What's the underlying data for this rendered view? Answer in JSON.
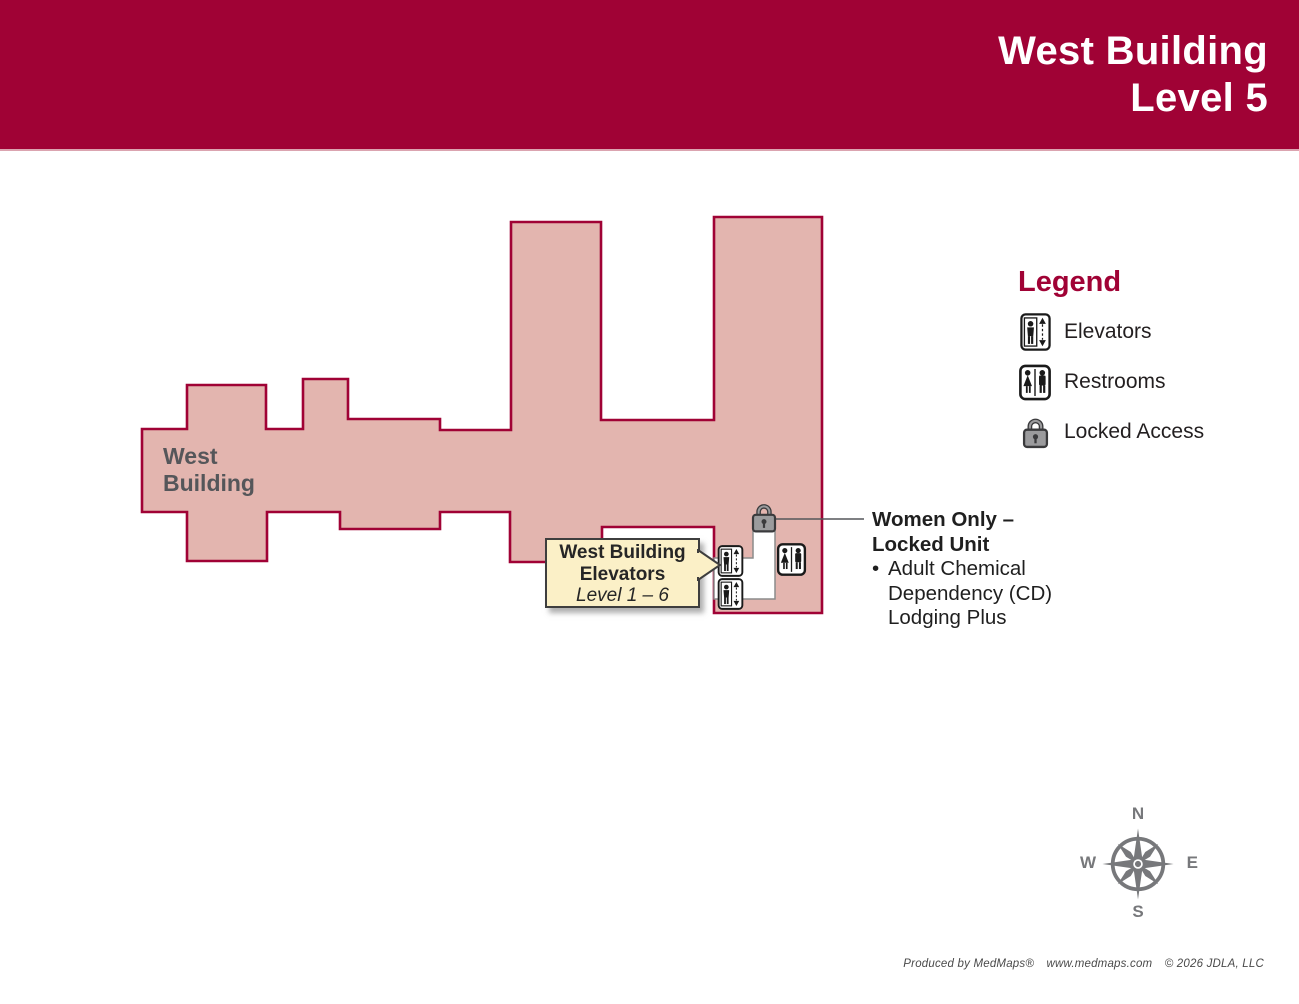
{
  "header": {
    "title_line1": "West Building",
    "title_line2": "Level 5"
  },
  "map_label": {
    "line1": "West",
    "line2": "Building"
  },
  "callout": {
    "title_line1": "West Building",
    "title_line2": "Elevators",
    "subtitle": "Level 1 – 6"
  },
  "annotation": {
    "title_line1": "Women Only –",
    "title_line2": "Locked Unit",
    "bullet": "•",
    "bullet_lines": [
      "Adult Chemical",
      "Dependency (CD)",
      "Lodging Plus"
    ]
  },
  "legend": {
    "title": "Legend",
    "items": [
      {
        "icon": "elevator-icon",
        "label": "Elevators"
      },
      {
        "icon": "restroom-icon",
        "label": "Restrooms"
      },
      {
        "icon": "lock-icon",
        "label": "Locked Access"
      }
    ]
  },
  "compass": {
    "n": "N",
    "e": "E",
    "s": "S",
    "w": "W"
  },
  "footer": {
    "parts": [
      "Produced by MedMaps®",
      "www.medmaps.com",
      "© 2026 JDLA, LLC"
    ]
  },
  "colors": {
    "header_red": "#A00235",
    "building_fill": "#E3B5AF",
    "building_outline": "#A00235",
    "callout_bg": "#FBF0C7",
    "label_gray": "#55565A",
    "compass_gray": "#77787B",
    "text_dark": "#231F20",
    "lock_gray": "#9B9B9D"
  }
}
